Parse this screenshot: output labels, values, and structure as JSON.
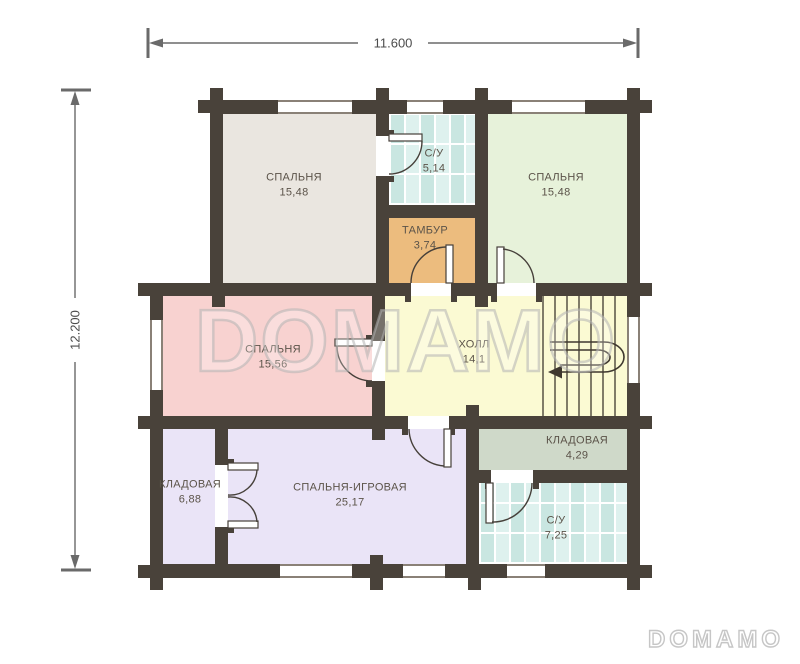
{
  "plan": {
    "dimensions": {
      "width_label": "11.600",
      "height_label": "12.200"
    },
    "rooms": [
      {
        "id": "bedroom-top-left",
        "name": "СПАЛЬНЯ",
        "area": "15,48",
        "color": "#eae6e0"
      },
      {
        "id": "bathroom-top",
        "name": "С/У",
        "area": "5,14",
        "color": "#def1ee"
      },
      {
        "id": "bedroom-top-right",
        "name": "СПАЛЬНЯ",
        "area": "15,48",
        "color": "#e7f2da"
      },
      {
        "id": "tambour",
        "name": "ТАМБУР",
        "area": "3,74",
        "color": "#ecbc7e"
      },
      {
        "id": "bedroom-middle",
        "name": "СПАЛЬНЯ",
        "area": "15,56",
        "color": "#f8d2d0"
      },
      {
        "id": "hall",
        "name": "ХОЛЛ",
        "area": "14,1",
        "color": "#fbfad3"
      },
      {
        "id": "storage-left",
        "name": "КЛАДОВАЯ",
        "area": "6,88",
        "color": "#eae4f7"
      },
      {
        "id": "bedroom-playroom",
        "name": "СПАЛЬНЯ-ИГРОВАЯ",
        "area": "25,17",
        "color": "#eae4f7"
      },
      {
        "id": "storage-right",
        "name": "КЛАДОВАЯ",
        "area": "4,29",
        "color": "#cfd9c9"
      },
      {
        "id": "bathroom-bottom",
        "name": "С/У",
        "area": "7,25",
        "color": "#def1ee"
      }
    ],
    "watermark": {
      "text": "DOMAMO"
    },
    "logo": {
      "text": "DOMAMO"
    },
    "palette": {
      "wall": "#49423a",
      "dimension_lines": "#6a6a6a",
      "label_text": "#5b5349",
      "tile_base": "#def1ee",
      "tile_alt": "#c9e6e1"
    }
  }
}
